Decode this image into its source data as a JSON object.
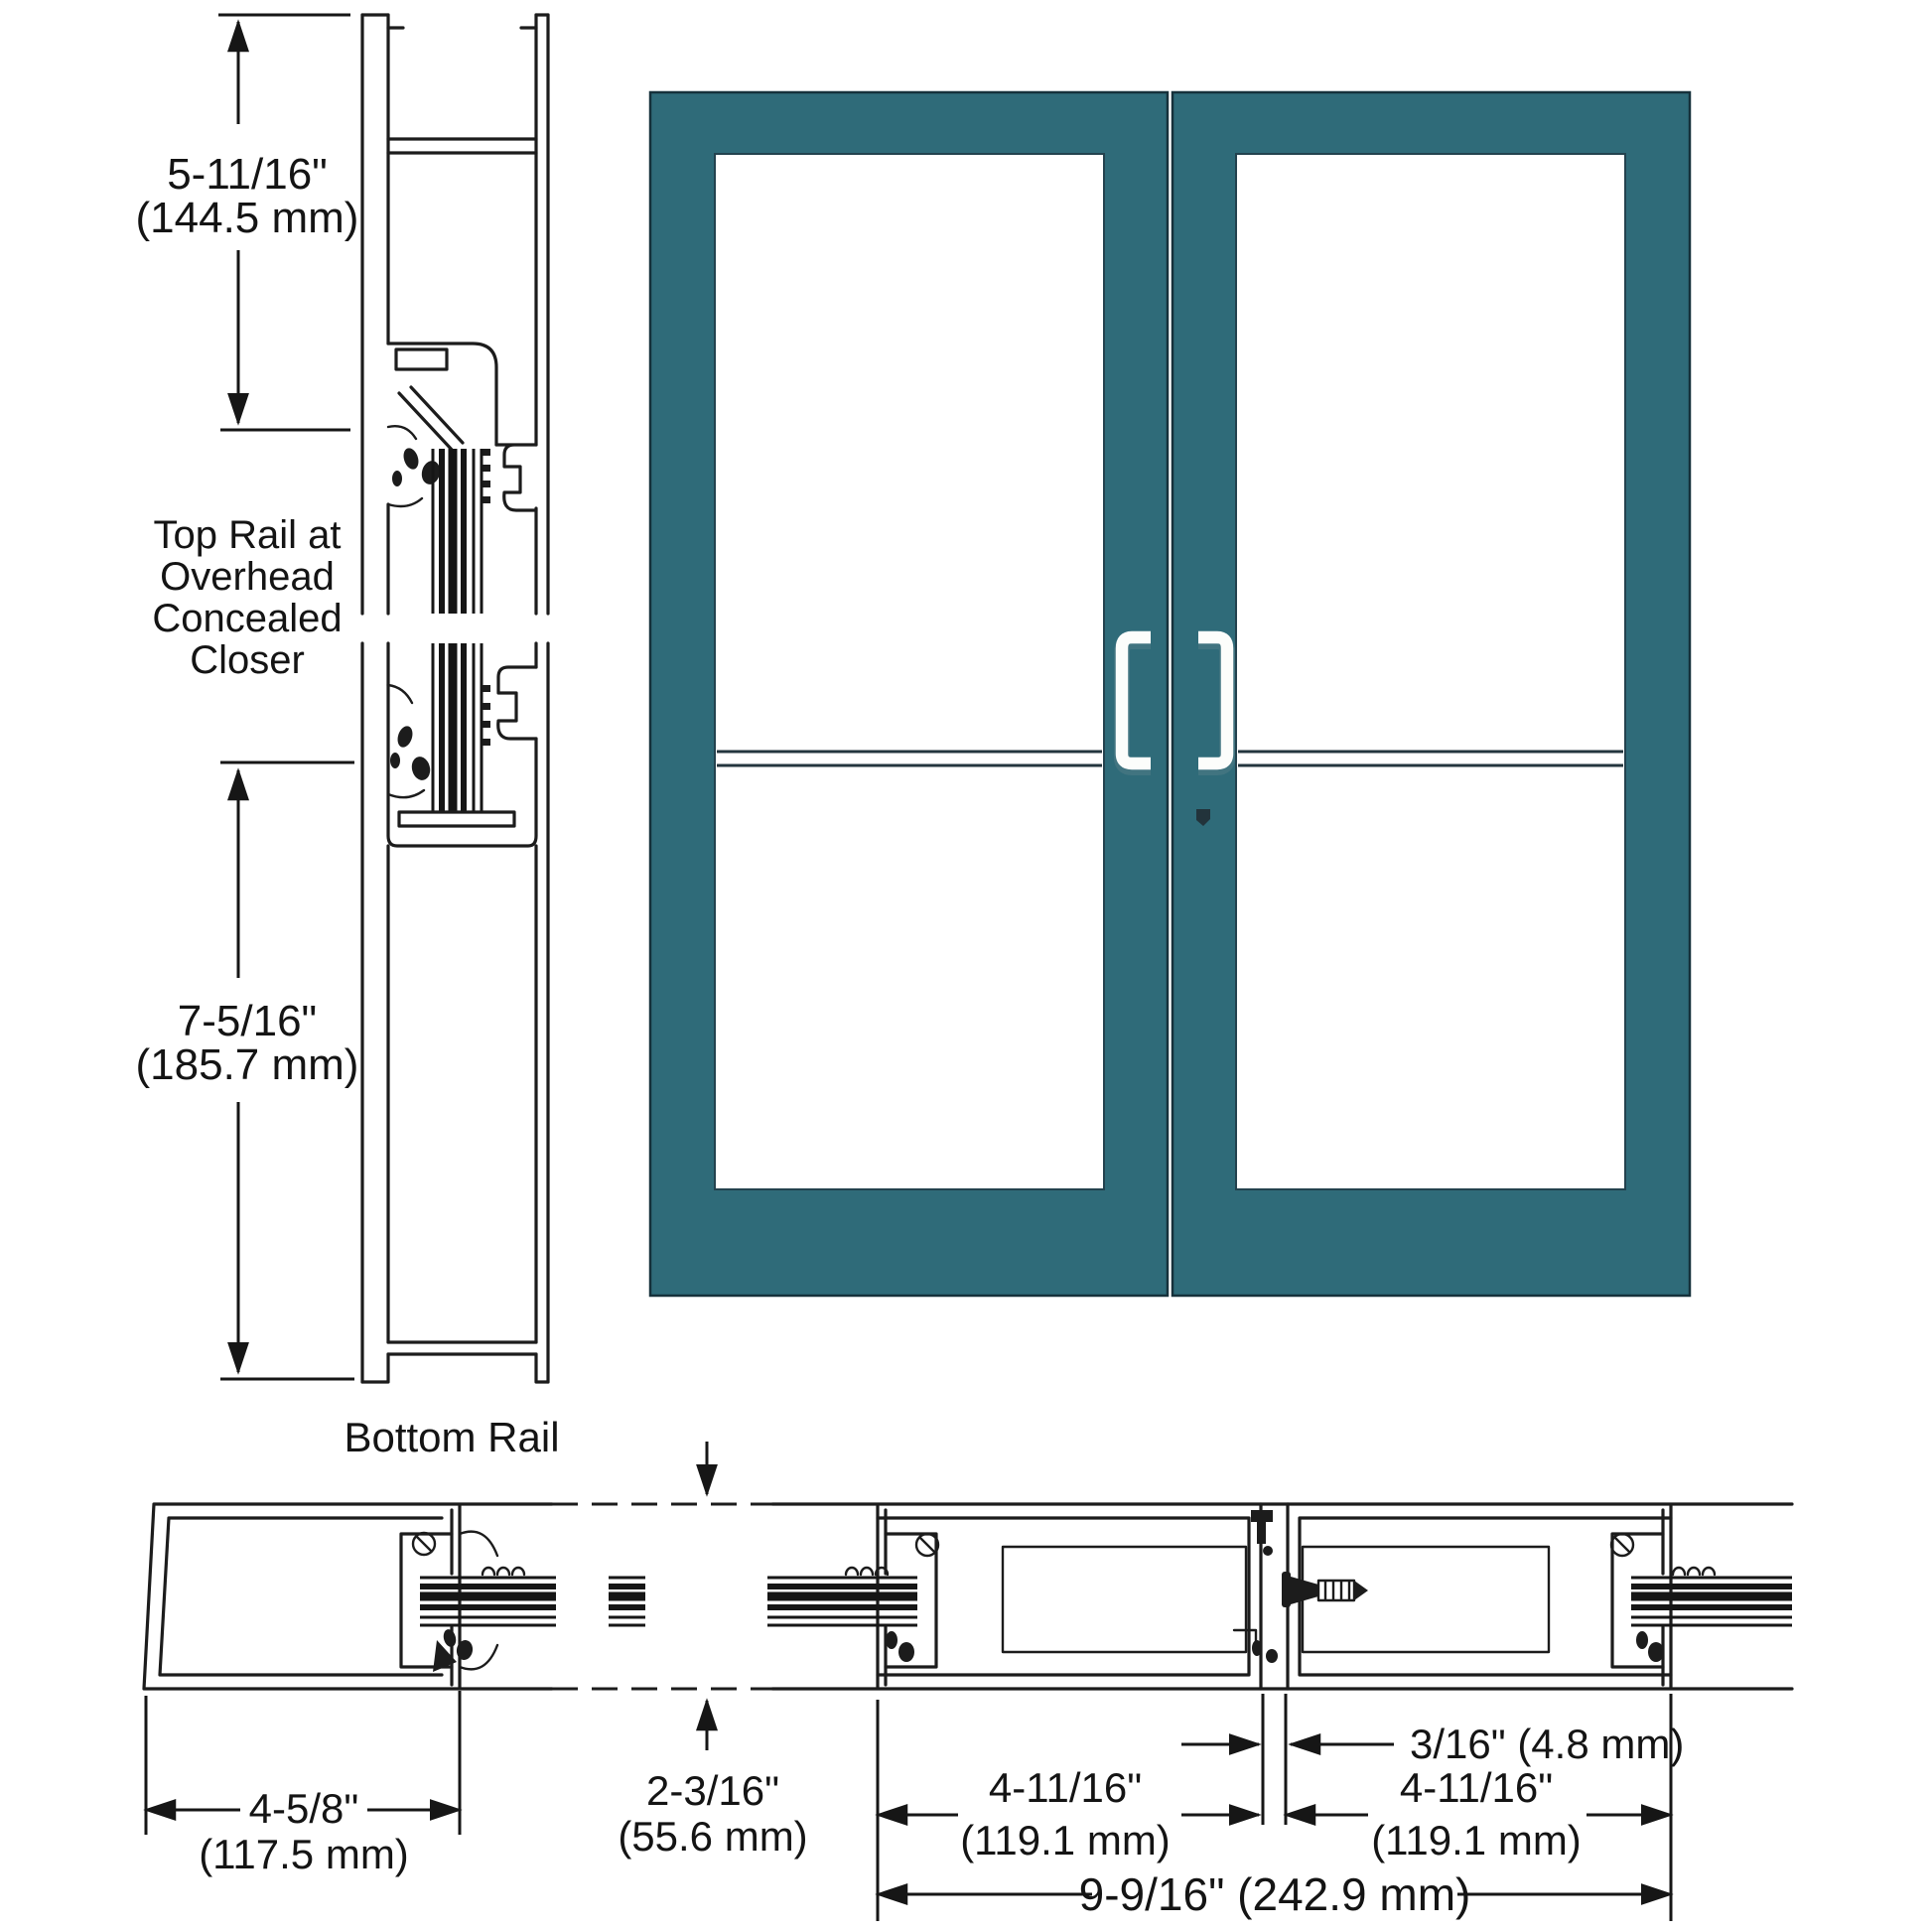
{
  "diagram": {
    "title": "storefront-door-pair-section-drawing",
    "labels": {
      "top_rail": [
        "Top Rail at",
        "Overhead",
        "Concealed",
        "Closer"
      ],
      "bottom_rail": "Bottom Rail"
    },
    "dimensions": {
      "top_rail_height_in": "5-11/16\"",
      "top_rail_height_mm": "(144.5 mm)",
      "bottom_rail_height_in": "7-5/16\"",
      "bottom_rail_height_mm": "(185.7 mm)",
      "jamb_stile_depth_in": "4-5/8\"",
      "jamb_stile_depth_mm": "(117.5 mm)",
      "door_thickness_in": "2-3/16\"",
      "door_thickness_mm": "(55.6 mm)",
      "lock_stile_left_in": "4-11/16\"",
      "lock_stile_left_mm": "(119.1 mm)",
      "meeting_gap": "3/16\" (4.8 mm)",
      "lock_stile_right_in": "4-11/16\"",
      "lock_stile_right_mm": "(119.1 mm)",
      "pair_total": "9-9/16\" (242.9 mm)"
    },
    "colors": {
      "door": "#2f6b79",
      "door_edge": "#16313b",
      "line": "#1c1c1c",
      "handle": "#fcfdfb"
    }
  }
}
